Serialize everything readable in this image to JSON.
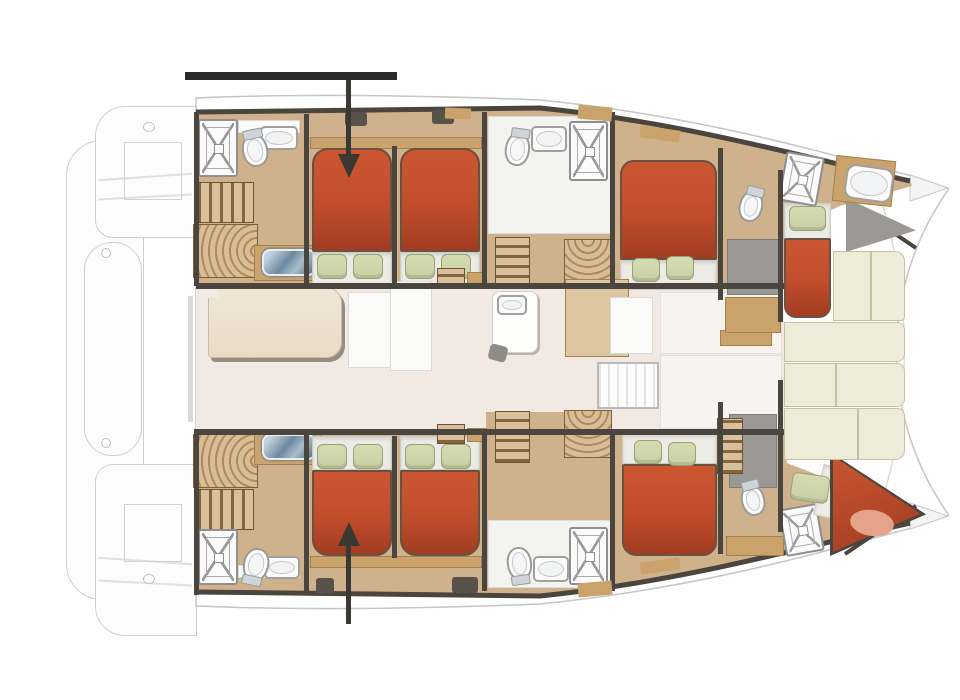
{
  "diagram": {
    "type": "yacht-deck-plan",
    "description": "Top-down interior layout plan of a sailing catamaran, bow pointing right, showing cabins, berths, bathrooms, galley and forward cockpit"
  },
  "annotations": {
    "top_bar": "horizontal-highlight-bar",
    "top_arrow": "arrow-down-icon pointing into port aft double berth",
    "bottom_arrow": "arrow-up-icon pointing into starboard aft double berth"
  },
  "inventory": {
    "double_beds": 7,
    "bow_crew_berth": 1,
    "showers": 6,
    "toilets": 6,
    "washbasins_blue": 2,
    "staircases": 4,
    "saloon_table": 1,
    "galley_island": 1,
    "forward_cockpit_cushions": 6
  },
  "palette": {
    "bed_red": "#c14d2c",
    "bed_red_dark": "#a13c22",
    "pillow_green": "#c9d0a4",
    "floor_tan": "#cfb28c",
    "wood_trim": "#c9a36b",
    "wood_dark": "#a5804f",
    "wall_dark": "#4a453e",
    "salon_floor": "#f2e9e3",
    "cream_cushion": "#edebd9",
    "hull_outline": "#c5c5c5",
    "annotation_black": "#2b2a28"
  }
}
